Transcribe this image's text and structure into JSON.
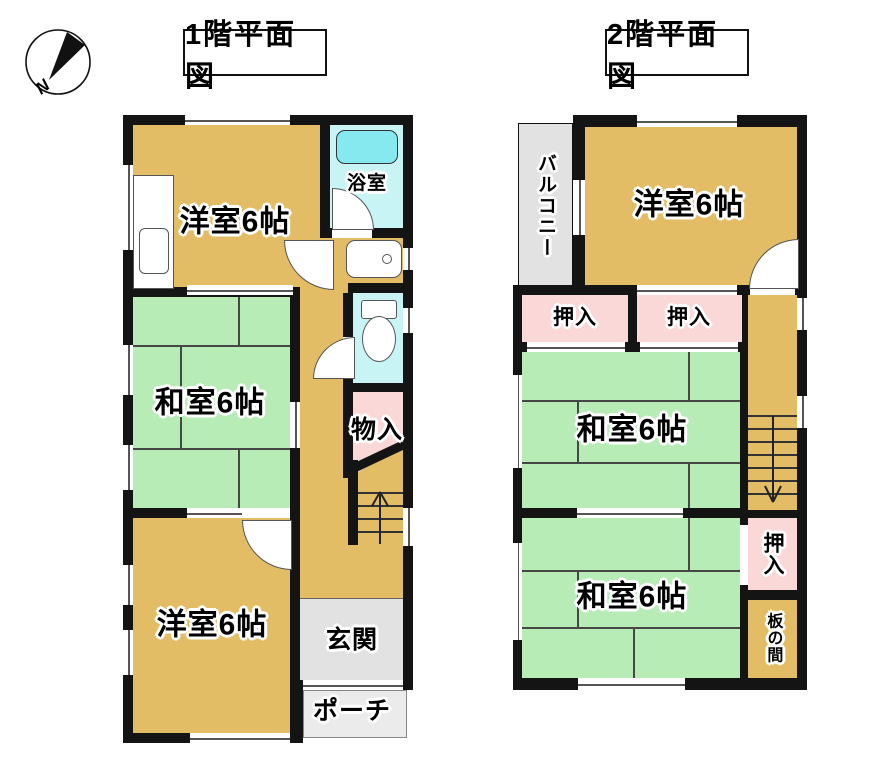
{
  "compass": {
    "north_label": "N"
  },
  "floor1": {
    "title": "1階平面図",
    "rooms": {
      "western_top": "洋室6帖",
      "bathroom": "浴室",
      "japanese": "和室6帖",
      "storage": "物入",
      "western_bottom": "洋室6帖",
      "entrance": "玄関",
      "porch": "ポーチ"
    }
  },
  "floor2": {
    "title": "2階平面図",
    "rooms": {
      "balcony": "バルコニー",
      "western": "洋室6帖",
      "closet_left": "押入",
      "closet_right": "押入",
      "japanese_middle": "和室6帖",
      "japanese_bottom": "和室6帖",
      "closet_lower": "押入",
      "wood_floor": "板の間"
    }
  },
  "colors": {
    "western_room": "#e3bc66",
    "japanese_room": "#b7ecb7",
    "closet": "#fad8d8",
    "bathroom": "#c9f4f6",
    "bathtub": "#85e9ef",
    "entrance_gray": "#e2e2e2",
    "porch_gray": "#ebebeb",
    "wall": "#141414"
  }
}
